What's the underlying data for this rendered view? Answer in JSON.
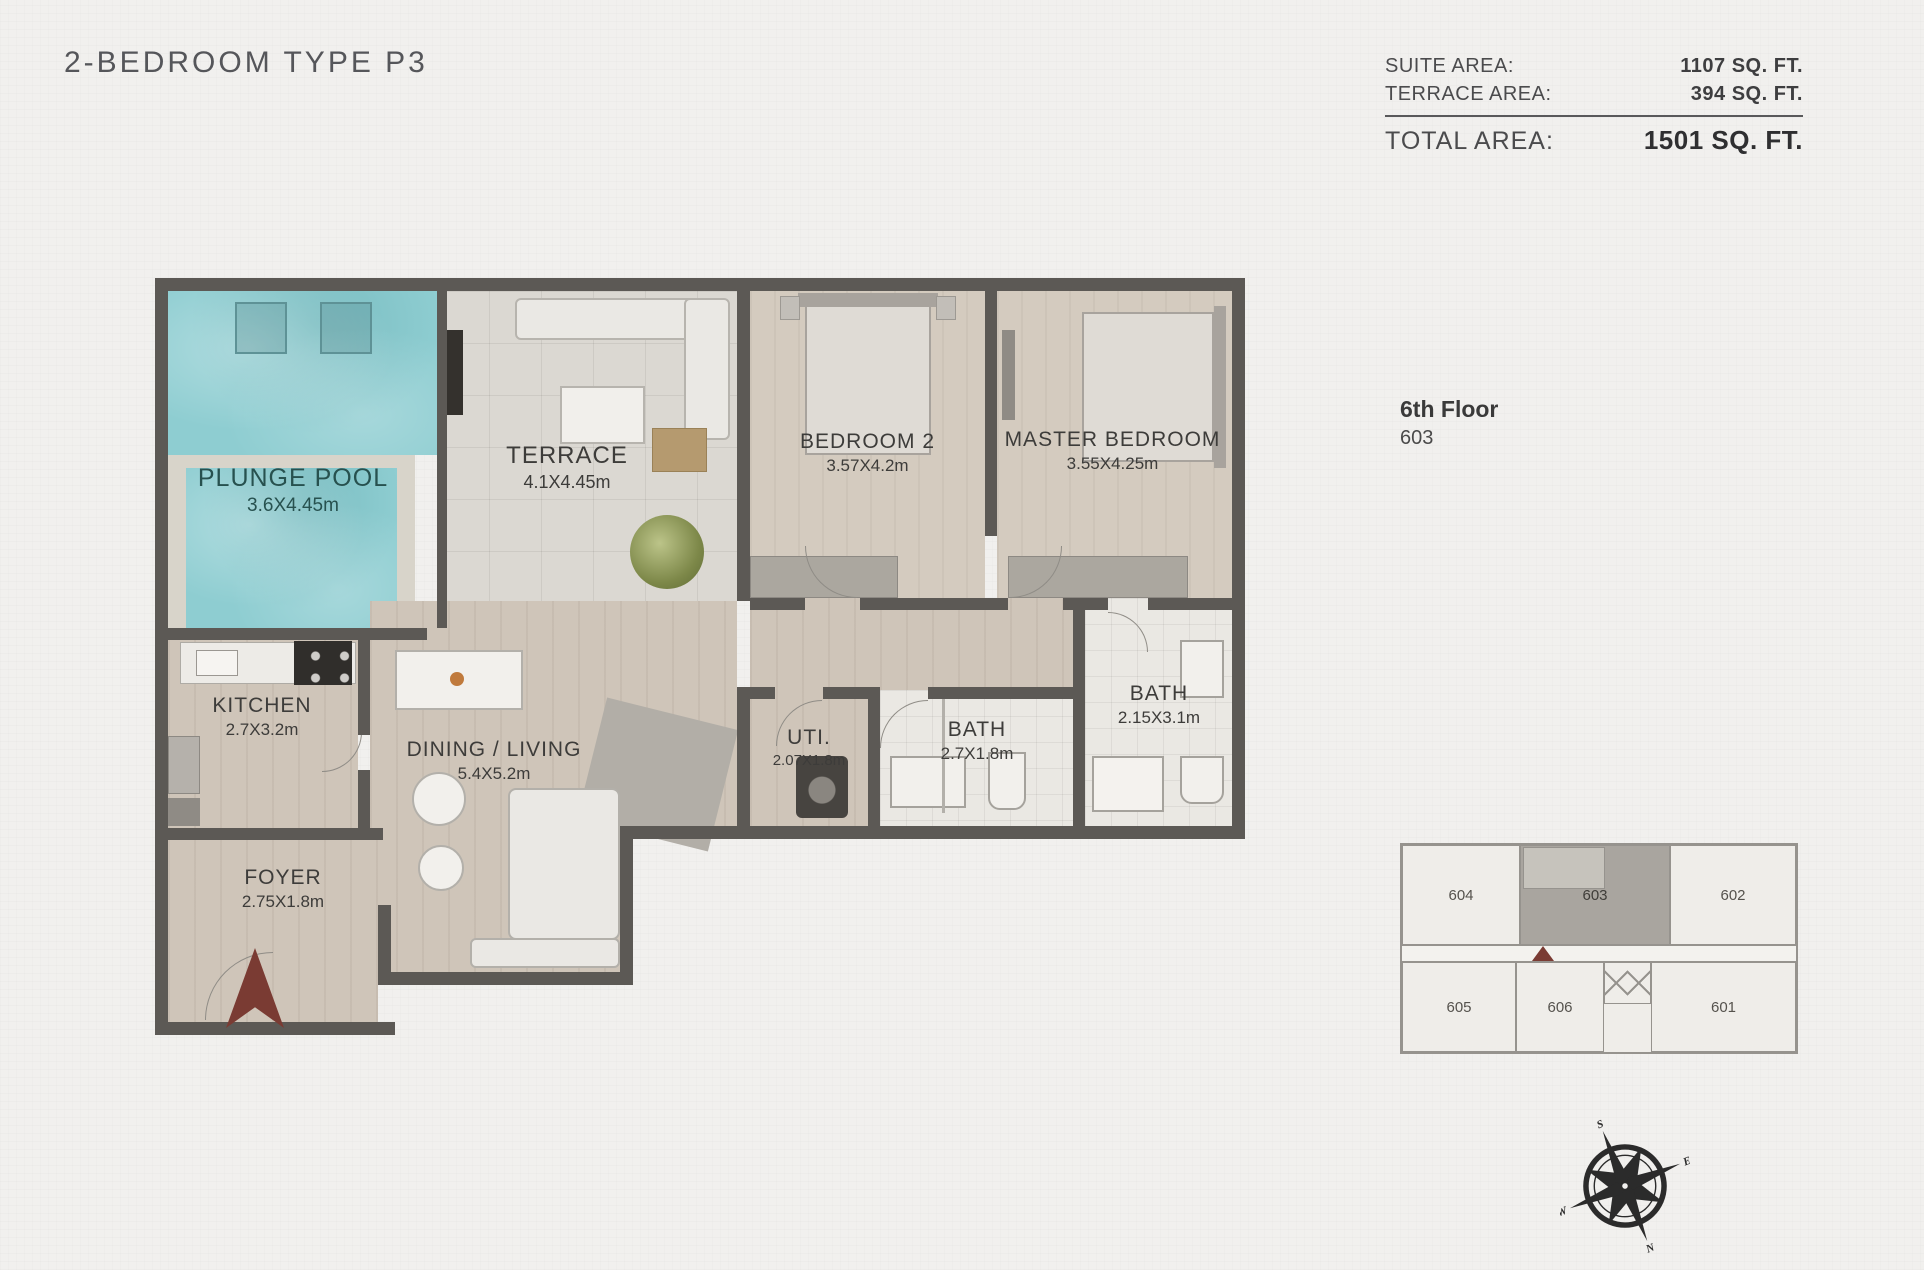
{
  "header": {
    "title": "2-BEDROOM TYPE P3",
    "area_table": {
      "suite_label": "SUITE AREA:",
      "suite_value": "1107 SQ. FT.",
      "terrace_label": "TERRACE AREA:",
      "terrace_value": "394 SQ. FT.",
      "total_label": "TOTAL AREA:",
      "total_value": "1501 SQ. FT."
    }
  },
  "floor_info": {
    "floor": "6th Floor",
    "unit": "603"
  },
  "rooms": [
    {
      "id": "plunge-pool",
      "name": "PLUNGE POOL",
      "dims": "3.6X4.45m"
    },
    {
      "id": "terrace",
      "name": "TERRACE",
      "dims": "4.1X4.45m"
    },
    {
      "id": "bedroom-2",
      "name": "BEDROOM 2",
      "dims": "3.57X4.2m"
    },
    {
      "id": "master-bedroom",
      "name": "MASTER BEDROOM",
      "dims": "3.55X4.25m"
    },
    {
      "id": "kitchen",
      "name": "KITCHEN",
      "dims": "2.7X3.2m"
    },
    {
      "id": "dining-living",
      "name": "DINING / LIVING",
      "dims": "5.4X5.2m"
    },
    {
      "id": "utility",
      "name": "UTI.",
      "dims": "2.07X1.8m"
    },
    {
      "id": "bath-1",
      "name": "BATH",
      "dims": "2.7X1.8m"
    },
    {
      "id": "bath-2",
      "name": "BATH",
      "dims": "2.15X3.1m"
    },
    {
      "id": "foyer",
      "name": "FOYER",
      "dims": "2.75X1.8m"
    }
  ],
  "key_plan": {
    "units": [
      "604",
      "603",
      "602",
      "605",
      "606",
      "601"
    ],
    "highlighted_unit": "603"
  },
  "compass": {
    "n": "N",
    "s": "S",
    "e": "E",
    "w": "W"
  },
  "colors": {
    "pool_water": "#8ecdd1",
    "wall": "#5c5955",
    "wood_floor": "#cfc5b9",
    "terrace_tile": "#dbd8d2",
    "entry_arrow": "#7a3b33",
    "key_highlight": "#a9a59f"
  }
}
